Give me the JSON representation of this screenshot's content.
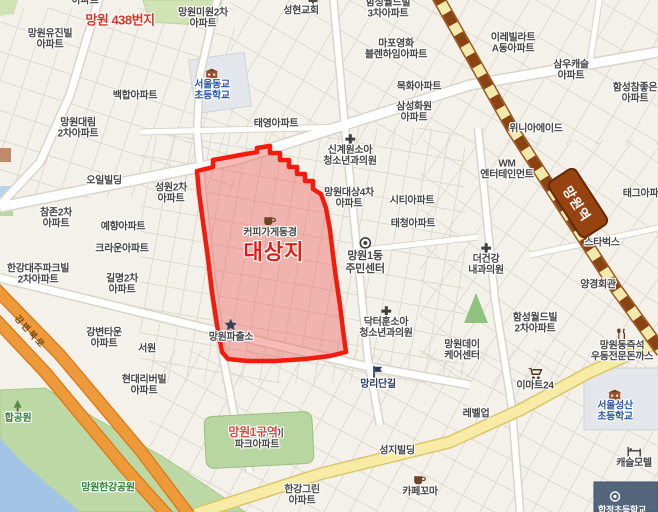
{
  "station": {
    "name": "망원역"
  },
  "colors": {
    "target_area_border": "#f31b0c",
    "target_area_fill": "rgba(233,93,88,0.42)",
    "railway_brown": "#8a4414",
    "railway_yellow": "#f2e9ac",
    "highway_orange": "#ef9a3a",
    "park_green": "#bcd9a5",
    "river_blue": "#a3c4e4",
    "school_text_blue": "#2b57a7",
    "annotation_red": "#e51a12"
  },
  "labels": [
    {
      "name": "fragment-apartment-top",
      "lines": [
        "아파트"
      ],
      "x": 85,
      "y": 1,
      "interactable": false
    },
    {
      "name": "annotation-mangwon-438",
      "lines": [
        "망원 438번지"
      ],
      "x": 120,
      "y": 21,
      "cls": "red-sm",
      "interactable": false
    },
    {
      "name": "poi-mangwon-yujinbil-apt",
      "lines": [
        "망원유진빌",
        "아파트"
      ],
      "x": 50,
      "y": 40
    },
    {
      "name": "poi-mangwon-miwon-2cha-apt",
      "lines": [
        "망원미원2차",
        "아파트"
      ],
      "x": 203,
      "y": 19
    },
    {
      "name": "church-icon-seonghyeon",
      "lines": [],
      "icon": "church-cross-icon",
      "x": 313,
      "y": 3,
      "interactable": false
    },
    {
      "name": "poi-seonghyeon-church",
      "lines": [
        "성현교회"
      ],
      "x": 301,
      "y": 11
    },
    {
      "name": "poi-hamseong-worldbil-3cha-apt",
      "lines": [
        "함성월드빌",
        "3차아파트"
      ],
      "x": 388,
      "y": 9
    },
    {
      "name": "poi-irebillart-adong-apt",
      "lines": [
        "이레빌라트",
        "A동아파트"
      ],
      "x": 513,
      "y": 44
    },
    {
      "name": "poi-mapo-yeonghwa-blenheim-apt",
      "lines": [
        "마포영화",
        "블렌하임아파트"
      ],
      "x": 396,
      "y": 50
    },
    {
      "name": "poi-samwoo-castle-apt",
      "lines": [
        "삼우캐슬",
        "아파트"
      ],
      "x": 571,
      "y": 71
    },
    {
      "name": "poi-mokhwa-apt",
      "lines": [
        "목화아파트"
      ],
      "x": 419,
      "y": 87
    },
    {
      "name": "poi-hamseong-chamjoeun-apt",
      "lines": [
        "함성참좋은",
        "아파트"
      ],
      "x": 635,
      "y": 94
    },
    {
      "name": "poi-seouldonggyo-elementary",
      "lines": [
        "서울동교",
        "초등학교"
      ],
      "x": 212,
      "y": 85,
      "cls": "school-blue",
      "icon": "school-building-icon"
    },
    {
      "name": "poi-baekhap-apt",
      "lines": [
        "백합아파트"
      ],
      "x": 135,
      "y": 96
    },
    {
      "name": "poi-mangwon-daerim-2cha-apt",
      "lines": [
        "망원대림",
        "2차아파트"
      ],
      "x": 78,
      "y": 129
    },
    {
      "name": "poi-taeyoung-apt",
      "lines": [
        "태영아파트"
      ],
      "x": 276,
      "y": 124
    },
    {
      "name": "poi-samsung-hwawon-apt",
      "lines": [
        "삼성화원",
        "아파트"
      ],
      "x": 414,
      "y": 113
    },
    {
      "name": "poi-winia-aid",
      "lines": [
        "위니아에이드"
      ],
      "x": 536,
      "y": 129
    },
    {
      "name": "poi-singyewon-pediatric-clinic",
      "lines": [
        "신계원소아",
        "청소년과의원"
      ],
      "x": 350,
      "y": 151,
      "icon": "medical-cross-icon"
    },
    {
      "name": "poi-oil-building",
      "lines": [
        "오일빌딩"
      ],
      "x": 104,
      "y": 181
    },
    {
      "name": "poi-seongwon-2cha-apt",
      "lines": [
        "성원2차",
        "아파트"
      ],
      "x": 171,
      "y": 194
    },
    {
      "name": "poi-mangwon-daesang-4cha-apt",
      "lines": [
        "망원대상4차",
        "아파트"
      ],
      "x": 349,
      "y": 199
    },
    {
      "name": "poi-city-apt",
      "lines": [
        "시티아파트"
      ],
      "x": 412,
      "y": 201
    },
    {
      "name": "poi-taecheong-apt",
      "lines": [
        "태청아파트"
      ],
      "x": 413,
      "y": 224
    },
    {
      "name": "poi-wm-entertainment",
      "lines": [
        "WM",
        "엔터테인먼트"
      ],
      "x": 507,
      "y": 170
    },
    {
      "name": "poi-tag-apt",
      "lines": [
        "태그아파트"
      ],
      "x": 645,
      "y": 194
    },
    {
      "name": "poi-starbucks",
      "lines": [
        "스타벅스"
      ],
      "x": 602,
      "y": 243
    },
    {
      "name": "poi-chamjon-2cha-apt",
      "lines": [
        "참존2차",
        "아파트"
      ],
      "x": 56,
      "y": 219
    },
    {
      "name": "poi-yehyang-apt",
      "lines": [
        "예향아파트"
      ],
      "x": 123,
      "y": 227
    },
    {
      "name": "poi-coffee-donggyeong",
      "lines": [
        "커피가게동경"
      ],
      "x": 270,
      "y": 227,
      "icon": "coffee-cup-icon"
    },
    {
      "name": "annotation-daesangji",
      "lines": [
        "대상지"
      ],
      "x": 274,
      "y": 253,
      "cls": "red-big",
      "interactable": false
    },
    {
      "name": "poi-mangwon1dong-community-center",
      "lines": [
        "망원1동",
        "주민센터"
      ],
      "x": 365,
      "y": 256,
      "fs": 11,
      "icon": "gov-office-icon"
    },
    {
      "name": "poi-deogeongang-clinic",
      "lines": [
        "더건강",
        "내과의원"
      ],
      "x": 486,
      "y": 260,
      "icon": "medical-cross-icon"
    },
    {
      "name": "poi-crown-apt",
      "lines": [
        "크라운아파트"
      ],
      "x": 122,
      "y": 249
    },
    {
      "name": "poi-hangang-daeju-parkbil-2cha-apt",
      "lines": [
        "한강대주파크빌",
        "2차아파트"
      ],
      "x": 38,
      "y": 275
    },
    {
      "name": "poi-gilmyeong-2cha-apt",
      "lines": [
        "길명2차",
        "아파트"
      ],
      "x": 122,
      "y": 285
    },
    {
      "name": "poi-yanggyeong-hoegwan",
      "lines": [
        "양경회관"
      ],
      "x": 598,
      "y": 285
    },
    {
      "name": "poi-gangbyeon-town-apt",
      "lines": [
        "강변타운",
        "아파트"
      ],
      "x": 104,
      "y": 339
    },
    {
      "name": "poi-seowon",
      "lines": [
        "서원"
      ],
      "x": 147,
      "y": 349
    },
    {
      "name": "poi-mangwon-police-box",
      "lines": [
        "망원파출소"
      ],
      "x": 231,
      "y": 331,
      "icon": "police-star-icon"
    },
    {
      "name": "poi-doctorhun-pediatric-clinic",
      "lines": [
        "닥터훈소아",
        "청소년과의원"
      ],
      "x": 386,
      "y": 323,
      "icon": "medical-cross-icon"
    },
    {
      "name": "poi-hamseong-worldbil-2cha-apt",
      "lines": [
        "함성월드빌",
        "2차아파트"
      ],
      "x": 535,
      "y": 324
    },
    {
      "name": "poi-mangwonday-care-center",
      "lines": [
        "망원데이",
        "케어센터"
      ],
      "x": 462,
      "y": 351
    },
    {
      "name": "poi-jeukseok-udon-donkkaseu",
      "lines": [
        "망원동즉석",
        "우동전문돈까스"
      ],
      "x": 622,
      "y": 346,
      "icon": "utensils-icon"
    },
    {
      "name": "poi-mangnidangil",
      "lines": [
        "망리단길"
      ],
      "x": 378,
      "y": 378,
      "cls": "navy",
      "icon": "flag-icon"
    },
    {
      "name": "poi-emart24",
      "lines": [
        "이마트24"
      ],
      "x": 535,
      "y": 380,
      "icon": "shopping-cart-icon"
    },
    {
      "name": "poi-levelup",
      "lines": [
        "레벨업"
      ],
      "x": 476,
      "y": 414
    },
    {
      "name": "poi-hyundai-riverbil-apt",
      "lines": [
        "현대리버빌",
        "아파트"
      ],
      "x": 144,
      "y": 386
    },
    {
      "name": "poi-seoulseongsan-elementary",
      "lines": [
        "서울성산",
        "초등학교"
      ],
      "x": 615,
      "y": 406,
      "cls": "school-blue",
      "icon": "school-building-icon"
    },
    {
      "name": "poi-castle-motel",
      "lines": [
        "캐슬모텔"
      ],
      "x": 634,
      "y": 458,
      "icon": "bed-icon"
    },
    {
      "name": "poi-seongji-building",
      "lines": [
        "성지빌딩"
      ],
      "x": 397,
      "y": 451
    },
    {
      "name": "poi-hangang-green-apt",
      "lines": [
        "한강그린",
        "아파트"
      ],
      "x": 302,
      "y": 496
    },
    {
      "name": "poi-cafe-kkoma",
      "lines": [
        "카페꼬마"
      ],
      "x": 420,
      "y": 486,
      "icon": "coffee-cup-icon"
    },
    {
      "name": "poi-mapo-hangang-ipark-apt",
      "lines": [
        "마포한강아이",
        "파크아파트"
      ],
      "x": 257,
      "y": 440
    },
    {
      "name": "annotation-mangwon1-guyeok",
      "lines": [
        "망원1구역"
      ],
      "x": 253,
      "y": 433,
      "cls": "red-sm2",
      "interactable": false
    },
    {
      "name": "poi-mangwon-hangang-park",
      "lines": [
        "망원한강공원"
      ],
      "x": 108,
      "y": 488,
      "cls": "park-green"
    },
    {
      "name": "poi-hap-park",
      "lines": [
        "합공원"
      ],
      "x": 18,
      "y": 412,
      "cls": "park-green",
      "icon": "tree-icon"
    },
    {
      "name": "road-gangbyeon-bukro",
      "lines": [
        "강변북로"
      ],
      "x": 30,
      "y": 332,
      "cls": "road-orange",
      "rot": 48,
      "interactable": false
    },
    {
      "name": "subway-entrance-icon-hapjeong",
      "lines": [],
      "icon": "subway-entrance-icon",
      "x": 615,
      "y": 497,
      "interactable": false
    },
    {
      "name": "poi-hapjeong-elementary-partial",
      "lines": [
        "합정초등학교"
      ],
      "x": 622,
      "y": 510,
      "cls": "white-navy"
    }
  ]
}
